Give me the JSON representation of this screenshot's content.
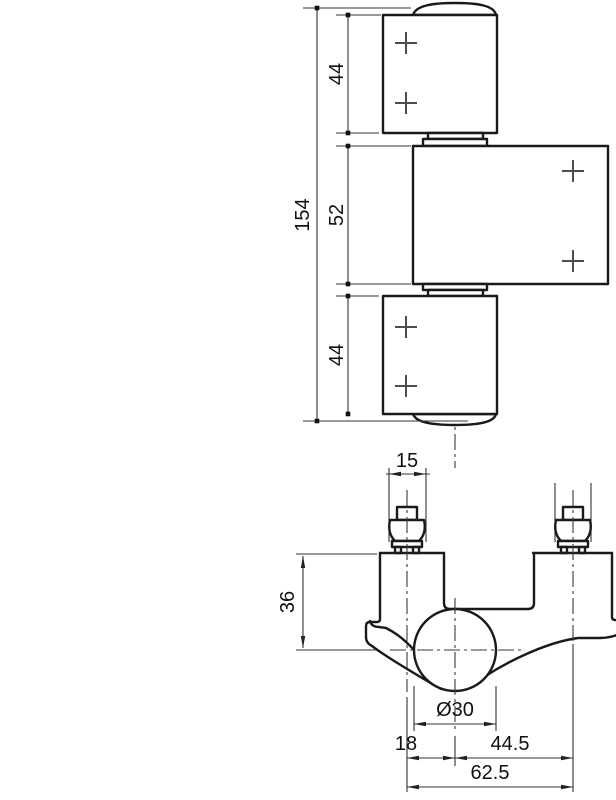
{
  "drawing": {
    "background": "#ffffff",
    "line_color": "#1a1a1a",
    "front_view": {
      "dims": {
        "overall_height": "154",
        "top_knuckle_height": "44",
        "middle_leaf_height": "52",
        "bottom_knuckle_height": "44"
      }
    },
    "bottom_view": {
      "dims": {
        "screw_head_width": "15",
        "body_depth": "36",
        "barrel_diameter": "Ø30",
        "axis_offset": "18",
        "axis_to_right_screw": "44.5",
        "screw_spacing": "62.5"
      }
    }
  }
}
